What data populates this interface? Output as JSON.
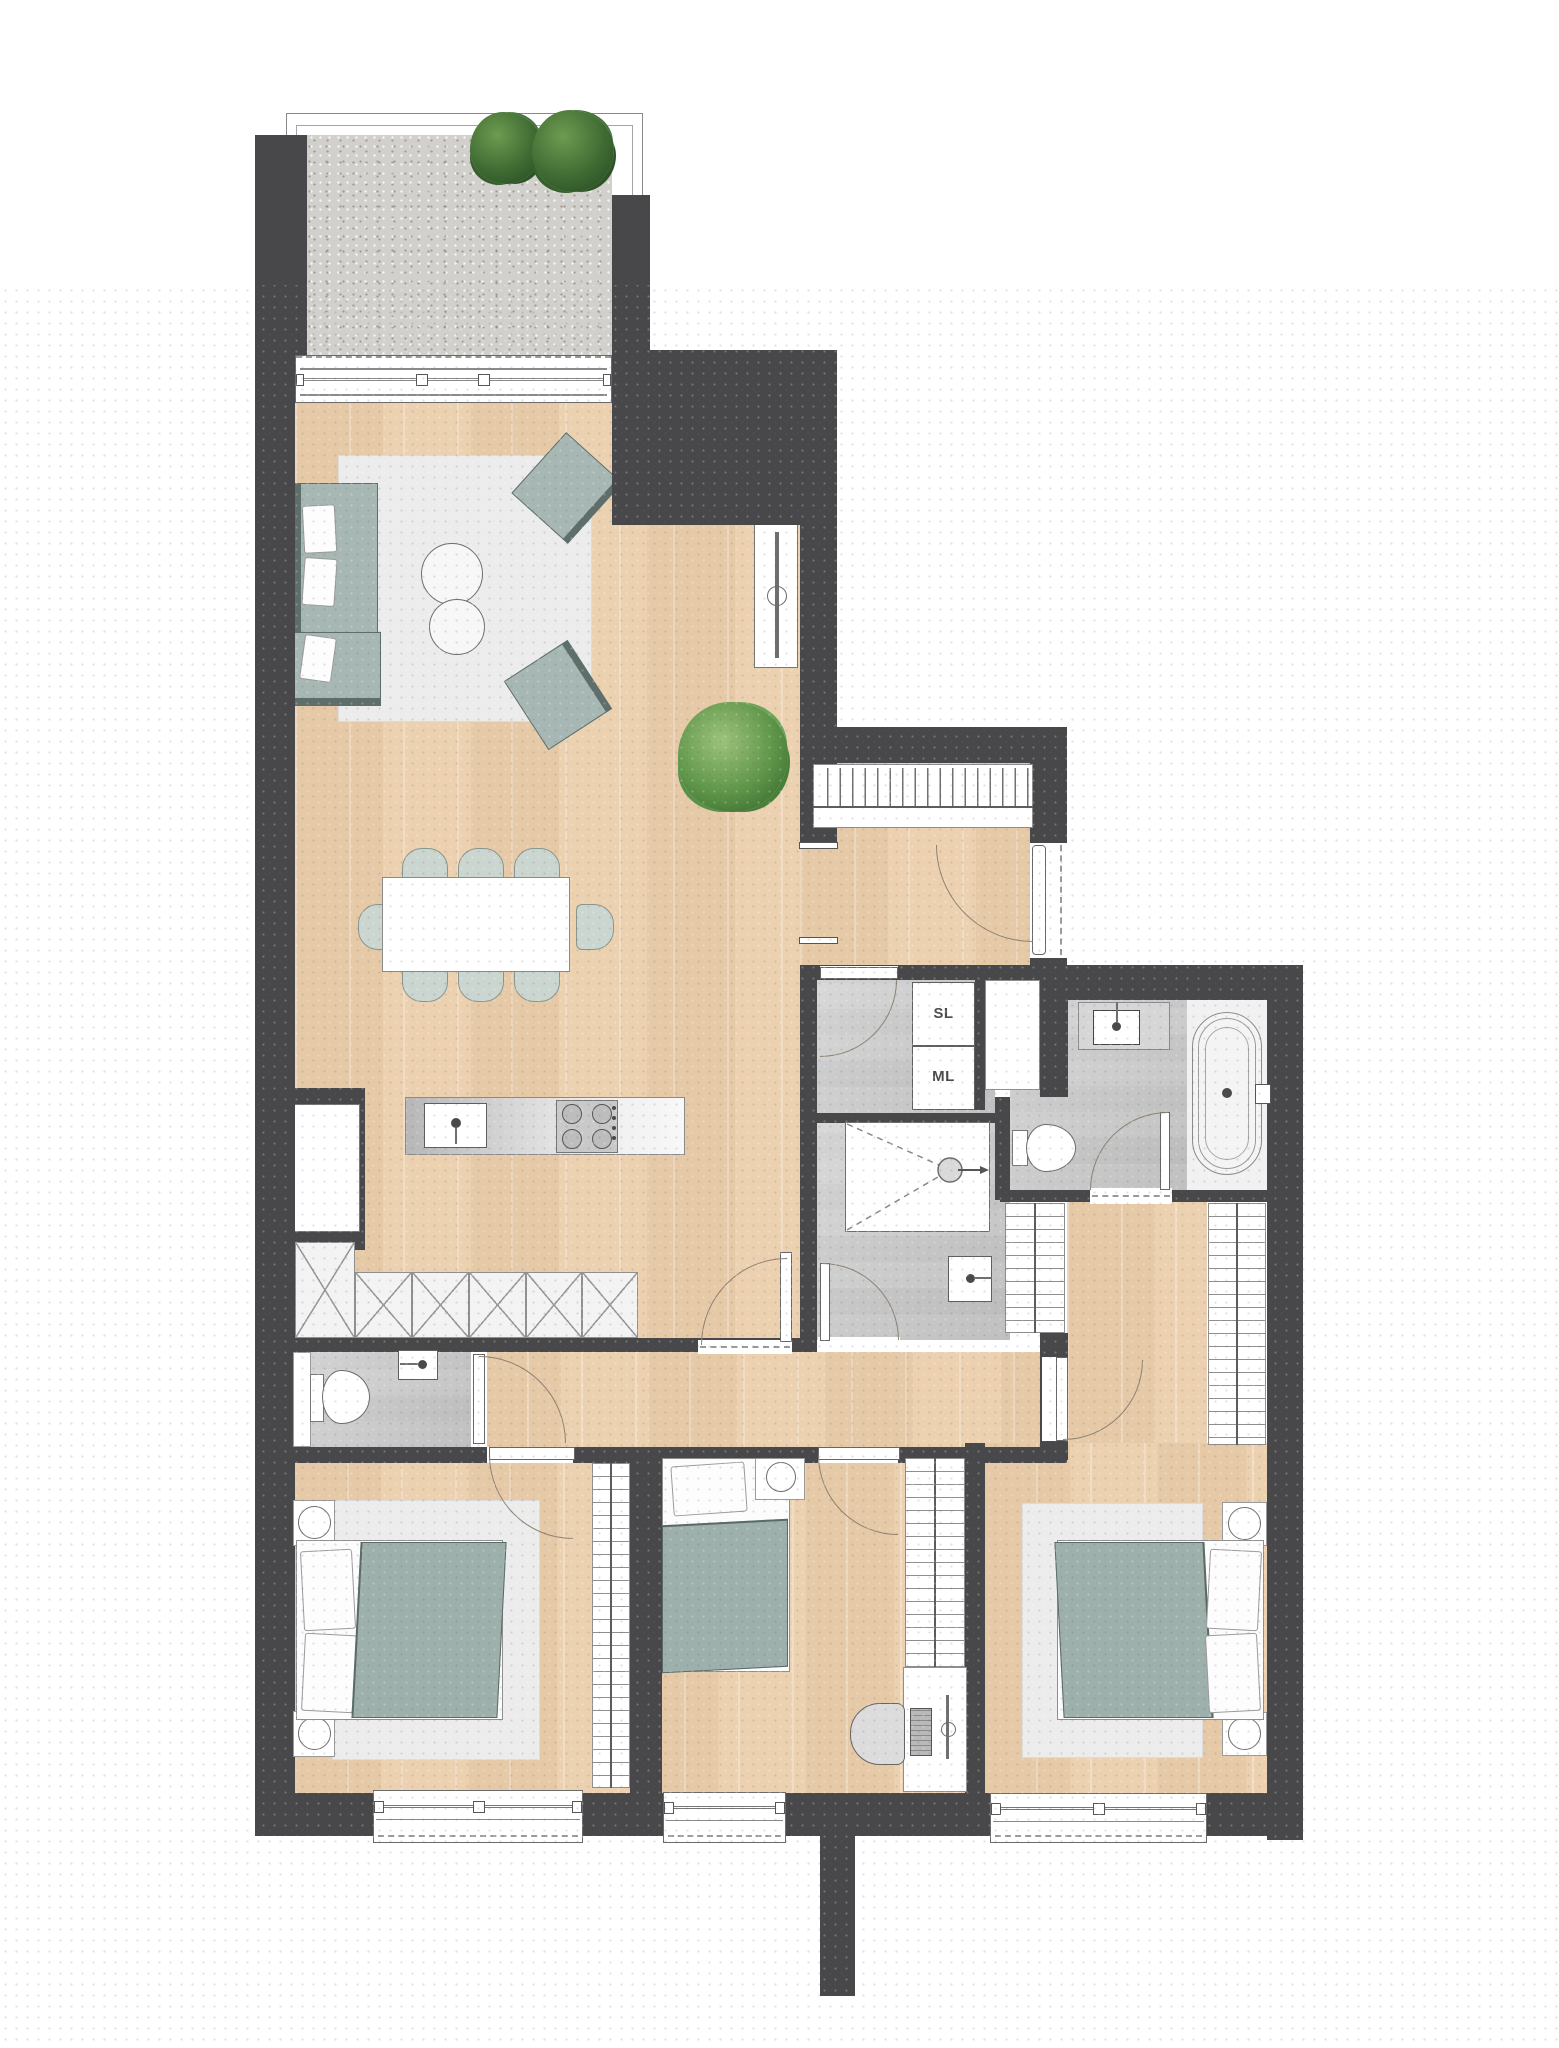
{
  "plan": {
    "type": "apartment-floor-plan",
    "labels": {
      "appliance_sl": "SL",
      "appliance_ml": "ML"
    },
    "colors": {
      "wall": "#48484b",
      "wood_floor": "#eed3b3",
      "tile_floor": "#c6c6c6",
      "furniture_sage": "#a7b8b4",
      "duvet_sage": "#9db0ac",
      "rug": "#ececec",
      "gravel": "#d2d0cc",
      "bush_green": "#3f6b33",
      "plant_green": "#5d9448",
      "background_dot": "#9a9a9a"
    },
    "rooms": [
      {
        "name": "terrace"
      },
      {
        "name": "living-dining-kitchen"
      },
      {
        "name": "entrance-hall"
      },
      {
        "name": "utility-room"
      },
      {
        "name": "shower-room"
      },
      {
        "name": "bathroom"
      },
      {
        "name": "wc"
      },
      {
        "name": "hallway"
      },
      {
        "name": "walk-in-closet"
      },
      {
        "name": "bedroom-left"
      },
      {
        "name": "bedroom-middle"
      },
      {
        "name": "bedroom-master"
      }
    ]
  }
}
